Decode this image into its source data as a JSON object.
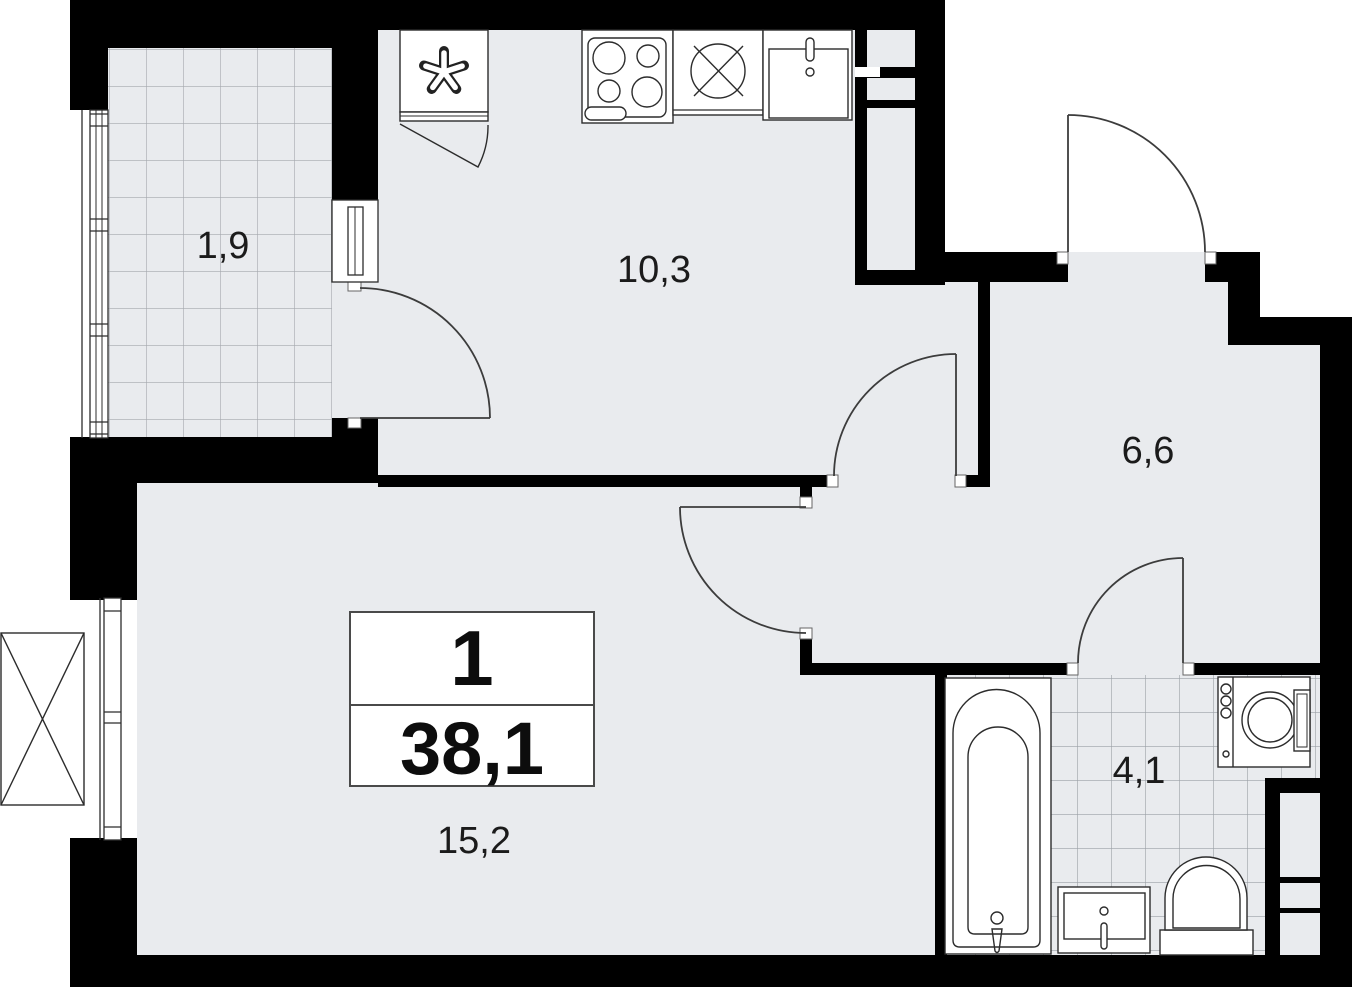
{
  "unit_card": {
    "rooms_count": "1",
    "total_area": "38,1"
  },
  "room_labels": {
    "balcony": "1,9",
    "kitchen": "10,3",
    "hallway": "6,6",
    "bathroom": "4,1",
    "living_room": "15,2"
  },
  "colors": {
    "wall": "#000000",
    "floor": "#e9ebee",
    "line": "#3c3c3c",
    "tile_line_balcony": "#a4a8ad",
    "tile_line_bathroom": "#9aa0a6",
    "background": "#ffffff"
  },
  "icons": [
    "fridge-icon",
    "stove-icon",
    "hood-icon",
    "kitchen-sink-icon",
    "bathtub-icon",
    "washing-machine-icon",
    "bathroom-sink-icon",
    "toilet-icon",
    "ac-unit-icon",
    "door-swing-icon",
    "window-icon"
  ]
}
